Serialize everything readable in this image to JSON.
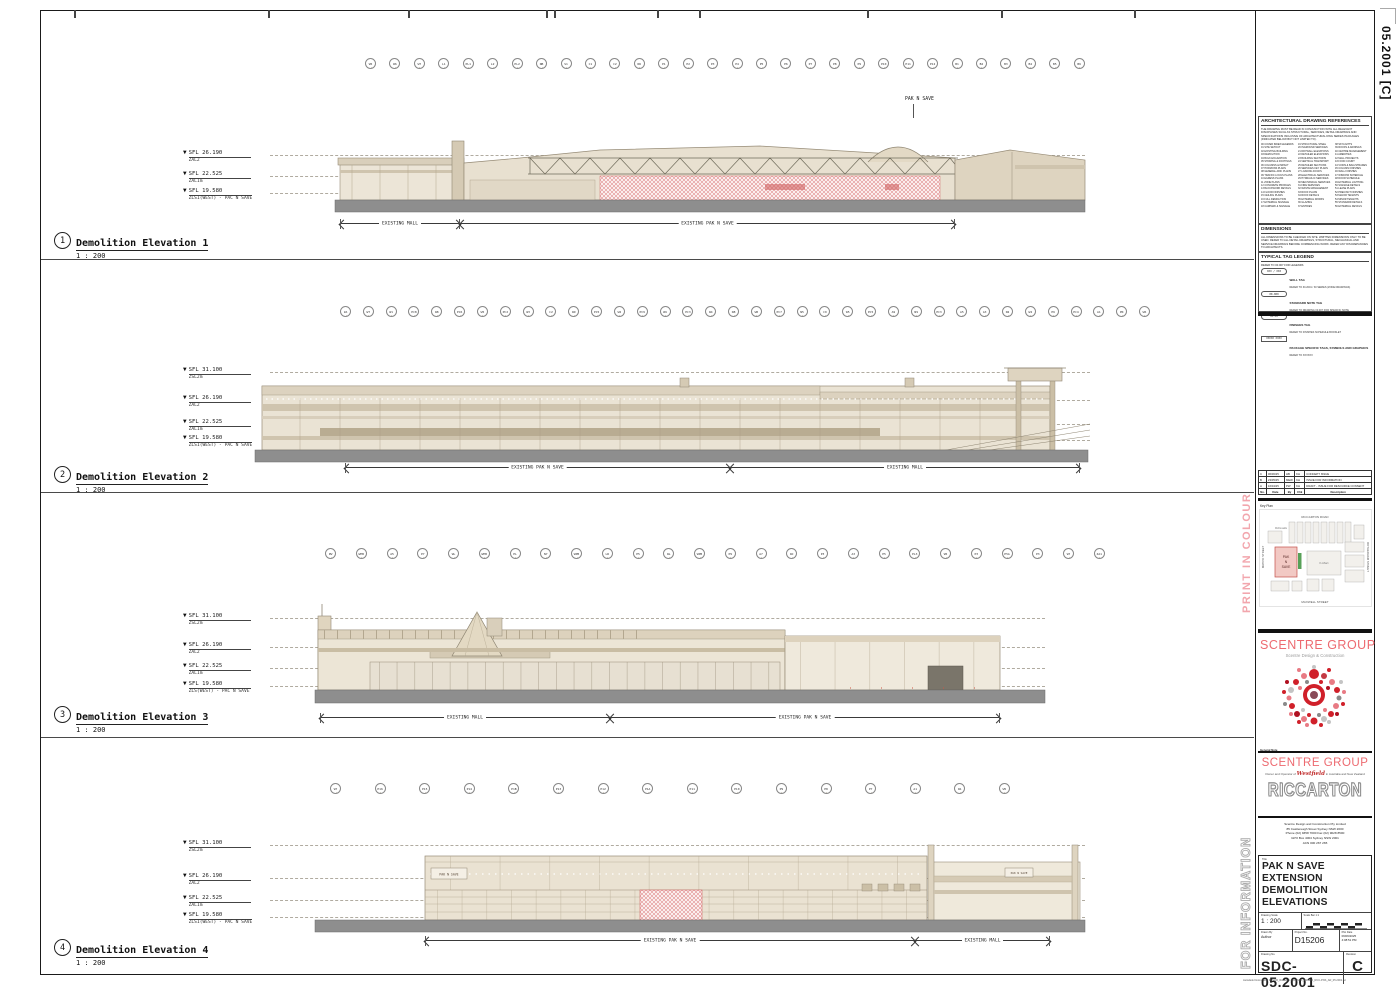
{
  "page": {
    "edge_label": "05.2001 [C]",
    "print_in_colour": "PRINT IN COLOUR",
    "for_information": "FOR INFORMATION",
    "footer_path": "Autodesk Docs://SDC D15206_Riccarton PNS/SDC_D15206_RCC-PNS_AR_05.2001.rvt"
  },
  "elevations": [
    {
      "num": "1",
      "title": "Demolition Elevation 1",
      "scale": "1 : 200",
      "annotation": "PAK N SAVE",
      "grids": [
        "W5",
        "W6",
        "W7",
        "L1",
        "PL1",
        "L2",
        "PL2",
        "NB",
        "S1",
        "C1",
        "C2",
        "N6",
        "P1",
        "P2",
        "P3",
        "P4",
        "P5",
        "P6",
        "P7",
        "P8",
        "P9",
        "P10",
        "P11",
        "P12",
        "B1",
        "B2",
        "B3",
        "B4",
        "B5",
        "B6"
      ],
      "levels": [
        {
          "sfl": "SFL 26.190",
          "name": "ZAL2"
        },
        {
          "sfl": "SFL 22.525",
          "name": "ZAL1m"
        },
        {
          "sfl": "SFL 19.580",
          "name": "ZLS1(WEST) - PAC N SAVE"
        }
      ],
      "dims": [
        "EXISTING MALL",
        "EXISTING PAK N SAVE"
      ]
    },
    {
      "num": "2",
      "title": "Demolition Elevation 2",
      "scale": "1 : 200",
      "grids": [
        "ZA",
        "W7",
        "W1",
        "PC8",
        "W8",
        "PC6",
        "W5",
        "PC2",
        "W3",
        "C2",
        "W9",
        "PC5",
        "W2",
        "PC9",
        "W6",
        "PC3",
        "W4",
        "N8",
        "W0",
        "PC7",
        "N5",
        "C9",
        "W5",
        "PC5",
        "A9",
        "N9",
        "PC3",
        "A5",
        "A3",
        "N2",
        "W4",
        "P6",
        "PC4",
        "A1",
        "PR",
        "W6"
      ],
      "levels": [
        {
          "sfl": "SFL 31.100",
          "name": "ZSL2m"
        },
        {
          "sfl": "SFL 26.190",
          "name": "ZAL2"
        },
        {
          "sfl": "SFL 22.525",
          "name": "ZAL1m"
        },
        {
          "sfl": "SFL 19.580",
          "name": "ZLS1(WEST) - PAC N SAVE"
        }
      ],
      "dims": [
        "EXISTING PAK N SAVE",
        "EXISTING MALL"
      ]
    },
    {
      "num": "3",
      "title": "Demolition Elevation 3",
      "scale": "1 : 200",
      "grids": [
        "PW",
        "WPB",
        "A5",
        "P7",
        "WL",
        "WPB",
        "PL",
        "N7",
        "WPB",
        "LR",
        "P5",
        "WL",
        "WPB",
        "P9",
        "A7",
        "WC",
        "P3",
        "A3",
        "P5",
        "PL3",
        "W5",
        "P3",
        "P5A",
        "P3",
        "W7",
        "ZA1"
      ],
      "levels": [
        {
          "sfl": "SFL 31.100",
          "name": "ZSL2m"
        },
        {
          "sfl": "SFL 26.190",
          "name": "ZAL2"
        },
        {
          "sfl": "SFL 22.525",
          "name": "ZAL1m"
        },
        {
          "sfl": "SFL 19.580",
          "name": "ZLS(WEST) - PAC N SAVE"
        }
      ],
      "dims": [
        "EXISTING MALL",
        "EXISTING PAK N SAVE"
      ]
    },
    {
      "num": "4",
      "title": "Demolition Elevation 4",
      "scale": "1 : 200",
      "sign": "PAK N SAVE",
      "sign2": "PAK N SAVE",
      "grids": [
        "W7",
        "P16",
        "P15",
        "P14",
        "P1B",
        "P13",
        "P12",
        "P1A",
        "P11",
        "P10",
        "P9",
        "P8",
        "P7",
        "A1",
        "W1",
        "W5"
      ],
      "levels": [
        {
          "sfl": "SFL 31.100",
          "name": "ZSL2m"
        },
        {
          "sfl": "SFL 26.190",
          "name": "ZAL2"
        },
        {
          "sfl": "SFL 22.525",
          "name": "ZAL1m"
        },
        {
          "sfl": "SFL 19.580",
          "name": "ZLS1(WEST) - PAC N SAVE"
        }
      ],
      "dims": [
        "EXISTING PAK N SAVE",
        "EXISTING MALL"
      ]
    }
  ],
  "references": {
    "heading": "ARCHITECTURAL DRAWING REFERENCES",
    "intro": "THE DRAWING MUST BE READ IN CONJUNCTION WITH ALL RELEVANT DISCIPLINES SUCH AS STRUCTURAL, SERVICES, DETAIL DRAWINGS AND SPECIFICATIONS INCLUSIVE OF ARCHITECTURAL DWG SERIES PACKAGES (INDICATED BELOW BUT NOT LIMITED TO).",
    "items": [
      "00 COVER INDEX/LEGENDS",
      "01 SITE SETOUT",
      "02 EXISTING BUILDING",
      "03 DEMOLITION",
      "04 BULK EXCAVATION",
      "05 SHORING & FOOTINGS",
      "06 COLUMNS & IMPACT",
      "07 HORIZONS PLANS",
      "08 GENERAL ARR. PLANS",
      "09 TRAFFIC LOCUS PLANS",
      "10 EGRESS PLANS",
      "11 ZONE PLANS",
      "12 CONCRETE PROFILES",
      "13 BLOCKWORK DETAILS",
      "14 FLOOR FINISHES",
      "15 CEILING PLANS",
      "16 FULL DEMOLITION",
      "17 EXTERNAL SIGNAGE",
      "18 CARPARK & SIGNAGE",
      "19 STRUCTURAL STEEL",
      "20 INGROUND SERVICES",
      "21 DRYWALL ELEVATIONS",
      "22 DETAILED ELEVATIONS",
      "23 BUILDING SECTIONS",
      "24 VERTICAL TRANSPORT",
      "25 DETAILED SECTIONS",
      "26 SERVICES KEY PLANS",
      "27 LOADING DOCKS",
      "28 ELECTRICAL SERVICES",
      "29 HYDRAULIC SERVICES",
      "30 MECHANICAL SERVICES",
      "31 FIRE SERVICES",
      "32 WASTE MANAGEMENT",
      "33 ROOF PLANS",
      "34 ROOF DETAILS",
      "35 EXTERNAL WORKS",
      "36 GLAZING",
      "37 ENTRIES",
      "38 SKYLIGHTS",
      "39 ROOFS & AWNINGS",
      "40 CENTRE MANAGEMENT",
      "41 AMENITIES",
      "42 MALL PROJECTS",
      "43 FOOD COURT",
      "44 VOIDS & BALUSTRADES",
      "45 COLUMN FINISHES",
      "46 WALL FINISHES",
      "47 WINDOW SCHEDULE",
      "48 DOOR SCHEDULE",
      "49 EXTERNAL LIGHTING",
      "50 SIGNAGE DETAILS",
      "51 LEASE PLANS",
      "52 PRECINCT FINISHES",
      "53 MAJOR TENANTS",
      "54 MINOR TENANTS",
      "55 STANDARD DETAILS",
      "56 EXTERNAL DETAILS"
    ]
  },
  "dimensions_note": {
    "heading": "DIMENSIONS",
    "text": "ALL DIMENSIONS TO BE CHECKED ON SITE. WRITTEN DIMENSIONS ONLY TO BE USED. REFER TO ALL DETAIL DRAWINGS, STRUCTURAL, MECHANICAL AND SERVICE DRAWINGS BEFORE COMMENCING WORK. REFER ANY DISCREPANCIES TO ARCHITECTS."
  },
  "tag_legend": {
    "heading": "TYPICAL TAG LEGEND",
    "sub": "REFER TO 00.007 FOR LEGENDS",
    "items": [
      {
        "sym": "XXX / XXX",
        "name": "WALL TAG",
        "desc": "REFER TO 30.2001 / 30 SERIES (ZONE DRAWINGS)"
      },
      {
        "sym": "00-000",
        "name": "STANDARD NOTE TAG",
        "desc": "REFER TO DRAWING 00.007 FOR SPECIFIC NOTE"
      },
      {
        "sym": "XX-XX",
        "name": "FINISHES TAG",
        "desc": "REFER TO FINISHES SCHEDULE BOOKLET"
      },
      {
        "sym": "XXXXX XXXX",
        "name": "PACKAGE SPECIFIC TAGS, SYMBOLS AND GRAPHICS",
        "desc": "REFER TO XXXXXX"
      }
    ]
  },
  "revisions": {
    "rows": [
      [
        "C",
        "06/06/25",
        "HB",
        "KH",
        "CONCEPT ISSUE"
      ],
      [
        "B",
        "23/05/25",
        "MEW",
        "KH",
        "ISSUE FOR INFORMATION"
      ],
      [
        "A",
        "16/04/25",
        "PW",
        "KH",
        "DRAFT - ISSUE FOR RESOURCE CONSENT"
      ],
      [
        "No.",
        "Date",
        "By",
        "Chk",
        "Description"
      ]
    ]
  },
  "keyplan": {
    "label": "Key Plan",
    "top": "RICCARTON ROAD",
    "bottom": "MAXWELL STREET",
    "left": "MATIPO STREET",
    "right": "ROTHERHAM STREET",
    "mcdonalds": "McDonalds",
    "kmart": "K-Mart",
    "pns": [
      "PAK",
      "N",
      "SAVE"
    ]
  },
  "branding": {
    "brand1": "SCENTRE GROUP",
    "brand1_sub": "Scentre Design & Construction",
    "general_note_label": "General Note",
    "general_note": "ALL DIMENSIONS TO BE CHECKED ON SITE. WRITTEN DIMENSIONS ONLY TO BE USED. REFER ANY DISCREPANCIES TO THE ARCHITECT BEFORE PROCEEDING. DO NOT SCALE FROM DRAWINGS.",
    "brand2": "SCENTRE GROUP",
    "tag_pre": "Owner and Operator of",
    "tag_brand": "Westfield",
    "tag_post": "in Australia and New Zealand",
    "centre_logo": "RICCARTON",
    "company": [
      "Scentre Design and Construction Pty Limited",
      "85 Castlereagh Street    Sydney NSW 2000",
      "Phone (02) 9358 7000    Fax (02) 9028 8500",
      "GPO Box 4004 Sydney NSW 2001",
      "ACN 000 267 265"
    ]
  },
  "title_block": {
    "title_label": "Title",
    "title_lines": [
      "PAK N SAVE EXTENSION",
      "DEMOLITION",
      "ELEVATIONS"
    ],
    "scale_label": "Drawing Scale",
    "scale_value": "1 : 200",
    "scale_bar_label": "Scale Bar 1:1",
    "drawn_label": "Drawn By",
    "drawn_value": "Author",
    "project_label": "Project No.",
    "project_value": "D15206",
    "plot_label": "Plot Date",
    "plot_date": "06/06/2025",
    "plot_time": "4:08:51 PM",
    "dwg_label": "Drawing No.",
    "dwg_value": "SDC-05.2001",
    "rev_label": "Revision",
    "rev_value": "C"
  },
  "colors": {
    "accent_pink": "#ED6A70",
    "demo_red": "#CC4444",
    "building_beige": "#EAE2D2",
    "ground_gray": "#8E8E8E"
  }
}
